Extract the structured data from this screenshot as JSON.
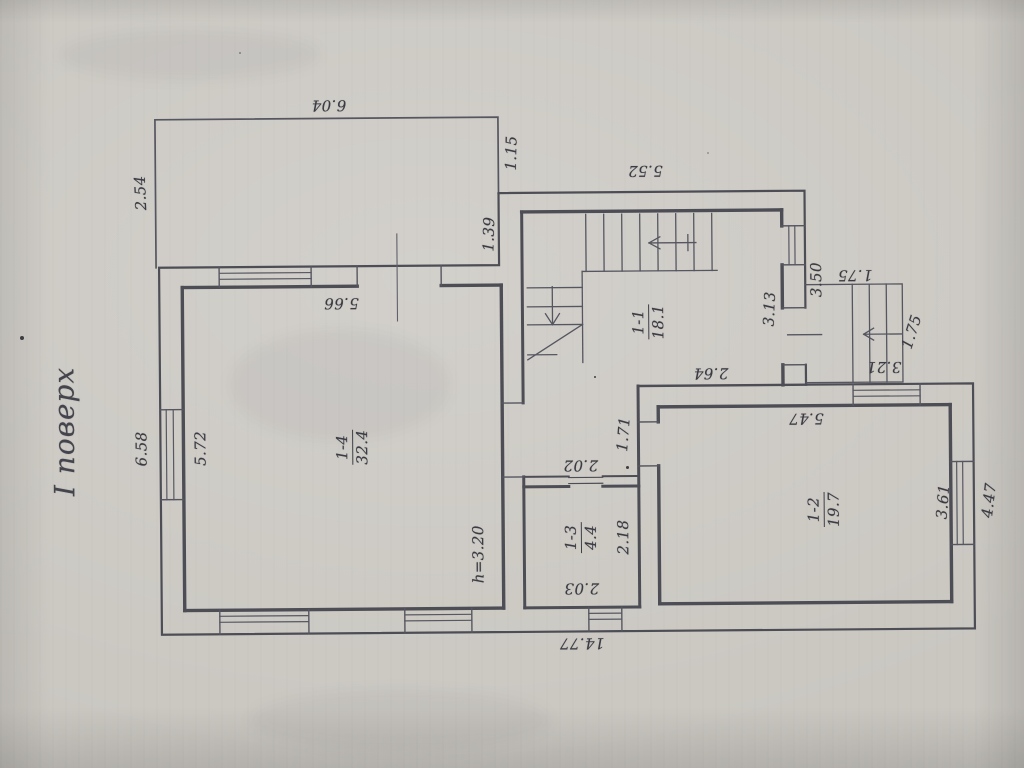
{
  "page": {
    "title": "І поверх"
  },
  "colors": {
    "paper": "#cac7c1",
    "ink": "#4d4d55",
    "text": "#3b3b43"
  },
  "floor_plan": {
    "rooms": [
      {
        "id": "1-1",
        "area": "18.1",
        "x": 649,
        "y": 323,
        "rot": -90
      },
      {
        "id": "1-2",
        "area": "19.7",
        "x": 823,
        "y": 512,
        "rot": -90
      },
      {
        "id": "1-3",
        "area": "4.4",
        "x": 580,
        "y": 538,
        "rot": -90
      },
      {
        "id": "1-4",
        "area": "32.4",
        "x": 352,
        "y": 446,
        "rot": -90
      }
    ],
    "dimensions": [
      {
        "text": "6.04",
        "x": 331,
        "y": 104,
        "rot": 180
      },
      {
        "text": "2.54",
        "x": 142,
        "y": 190,
        "rot": -92
      },
      {
        "text": "1.15",
        "x": 513,
        "y": 153,
        "rot": -88
      },
      {
        "text": "1.39",
        "x": 490,
        "y": 234,
        "rot": -88
      },
      {
        "text": "5.52",
        "x": 647,
        "y": 172,
        "rot": 180
      },
      {
        "text": "5.66",
        "x": 342,
        "y": 302,
        "rot": 180
      },
      {
        "text": "6.58",
        "x": 141,
        "y": 446,
        "rot": -90
      },
      {
        "text": "5.72",
        "x": 200,
        "y": 446,
        "rot": -90
      },
      {
        "text": "h=3.20",
        "x": 477,
        "y": 554,
        "rot": -90
      },
      {
        "text": "3.13",
        "x": 770,
        "y": 311,
        "rot": -87
      },
      {
        "text": "3.50",
        "x": 817,
        "y": 282,
        "rot": -90
      },
      {
        "text": "1.75",
        "x": 856,
        "y": 278,
        "rot": 180
      },
      {
        "text": "1.75",
        "x": 912,
        "y": 335,
        "rot": -72
      },
      {
        "text": "3.21",
        "x": 884,
        "y": 370,
        "rot": 180
      },
      {
        "text": "2.64",
        "x": 711,
        "y": 375,
        "rot": 180
      },
      {
        "text": "1.71",
        "x": 623,
        "y": 435,
        "rot": -85
      },
      {
        "text": "2.02",
        "x": 580,
        "y": 466,
        "rot": 180
      },
      {
        "text": "2.18",
        "x": 622,
        "y": 538,
        "rot": -90
      },
      {
        "text": "2.03",
        "x": 580,
        "y": 589,
        "rot": 180
      },
      {
        "text": "5.47",
        "x": 806,
        "y": 421,
        "rot": 180
      },
      {
        "text": "3.61",
        "x": 942,
        "y": 505,
        "rot": -85
      },
      {
        "text": "4.47",
        "x": 988,
        "y": 504,
        "rot": -83
      },
      {
        "text": "14.77",
        "x": 580,
        "y": 644,
        "rot": 180
      }
    ]
  }
}
